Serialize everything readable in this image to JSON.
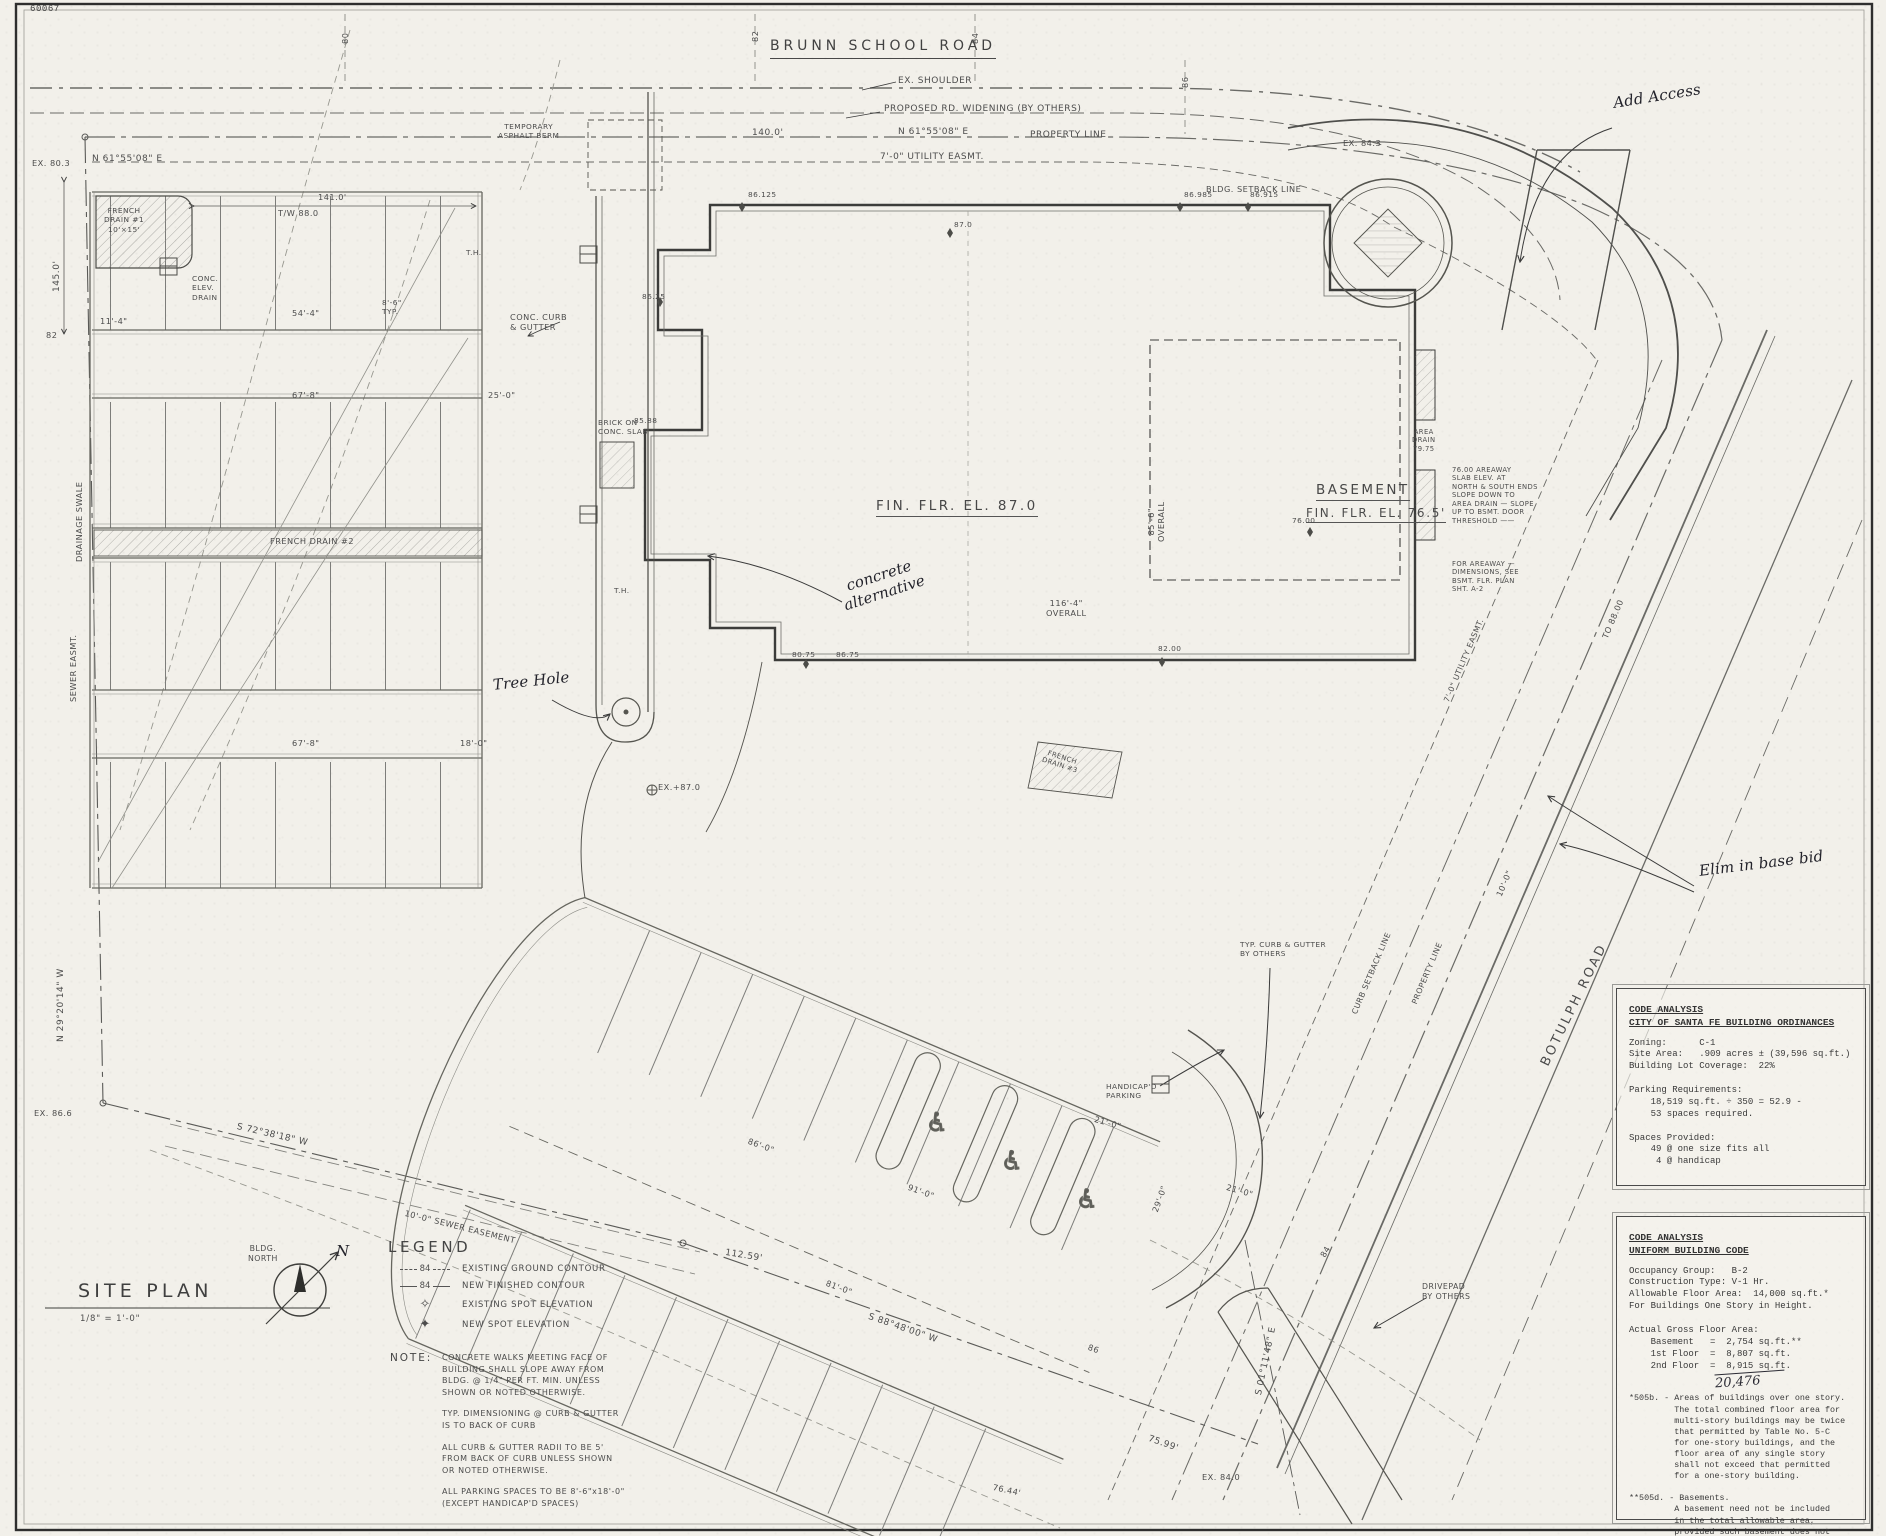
{
  "labels": {
    "sheet_no": "60067",
    "brunn_road": "BRUNN SCHOOL ROAD",
    "ex_shoulder": "EX. SHOULDER",
    "proposed_widening": "PROPOSED RD. WIDENING (BY OTHERS)",
    "dim_140": "140.0'",
    "bearing_ne": "N 61°55'08\" E",
    "property_line": "PROPERTY LINE",
    "utility_easmt": "7'-0\" UTILITY EASMT.",
    "temp_berm": "TEMPORARY\nASPHALT BERM",
    "bldg_setback": "BLDG. SETBACK LINE",
    "ex_843": "EX. 84.3",
    "ex_803": "EX. 80.3",
    "dim_145": "145.0'",
    "tw_880": "T/W 88.0",
    "dim_141": "141.0'",
    "french_drain_1": "FRENCH\nDRAIN #1\n10'×15'",
    "conc_elev_drain": "CONC.\nELEV.\nDRAIN",
    "drainage_swale": "DRAINAGE SWALE",
    "sewer_easmt": "SEWER EASMT.",
    "bearing_nw": "N 29°20'14\" W",
    "ex_866": "EX. 86.6",
    "bearing_sw": "S 72°38'18\" W",
    "sewer_easement_10": "10'-0\" SEWER EASEMENT",
    "dim_54_4": "54'-4\"",
    "dim_8_6": "8'-6\"\nTYP.",
    "dim_11_4": "11'-4\"",
    "dim_67_8": "67'-8\"",
    "dim_25_0": "25'-0\"",
    "dim_18_0": "18'-0\"",
    "conc_curb_gutter": "CONC. CURB\n& GUTTER",
    "french_drain_2": "FRENCH DRAIN #2",
    "french_drain_3": "FRENCH\nDRAIN #3",
    "fin_flr": "FIN. FLR. EL. 87.0",
    "basement": "BASEMENT",
    "basement_ffe": "FIN. FLR. EL. 76.5'",
    "overall_85": "85'-6\"\nOVERALL",
    "overall_116": "116'-4\"\nOVERALL",
    "areaway_note": "76.00 AREAWAY\nSLAB ELEV. AT\nNORTH & SOUTH ENDS\nSLOPE DOWN TO\nAREA DRAIN — SLOPE\nUP TO BSMT. DOOR\nTHRESHOLD ——",
    "areaway_dims": "FOR AREAWAY —\nDIMENSIONS, SEE\nBSMT. FLR. PLAN\nSHT. A-2",
    "area_drain": "AREA\nDRAIN\n79.75",
    "brick_slab": "BRICK ON\nCONC. SLAB",
    "ex_870": "EX.+87.0",
    "to_8800": "TO 88.00",
    "curb_setback": "CURB SETBACK LINE",
    "dim_10_0": "10'-0\"",
    "botulph": "BOTULPH ROAD",
    "typ_curb_others": "TYP. CURB & GUTTER\nBY OTHERS",
    "handicap_parking": "HANDICAP'D\nPARKING",
    "dim_21_0": "21'-0\"",
    "dim_29_0": "29'-0\"",
    "dim_91_0": "91'-0\"",
    "dim_81_0": "81'-0\"",
    "dim_86_0": "86'-0\"",
    "contour_84": "84",
    "contour_86": "86",
    "dim_112_59": "112.59'",
    "bearing_s88": "S 88°48'00\" W",
    "bearing_s01": "S 01°11'48\" E",
    "dim_75_99": "75.99'",
    "ex_840": "EX. 84.0",
    "dim_76_44": "76.44'",
    "drivepad": "DRIVEPAD\nBY OTHERS",
    "t_8200": "82.00",
    "t_7600": "76.00",
    "s86125": "86.125",
    "s86985": "86.985",
    "s86915": "86.915",
    "s870": "87.0",
    "s8625": "86.25",
    "s8588": "85.88",
    "s8075": "80.75",
    "s8675": "86.75",
    "c80": "80",
    "c82": "82",
    "c84": "84",
    "c86": "86",
    "th": "T.H."
  },
  "handwritten": {
    "add_access": "Add Access",
    "elim": "Elim in base bid",
    "concrete_alt": "concrete\nalternative",
    "tree_hole": "Tree Hole",
    "total": "20,476"
  },
  "icons": {
    "handicap": "♿",
    "spot_existing": "✧",
    "spot_new": "✦"
  },
  "legend": {
    "title": "LEGEND",
    "contour_value": "84",
    "existing_contour": "EXISTING GROUND CONTOUR",
    "new_contour": "NEW FINISHED CONTOUR",
    "existing_spot": "EXISTING SPOT ELEVATION",
    "new_spot": "NEW SPOT ELEVATION"
  },
  "notes": {
    "heading": "NOTE:",
    "p1": "CONCRETE WALKS MEETING FACE OF\nBUILDING SHALL SLOPE AWAY FROM\nBLDG. @ 1/4\" PER FT. MIN. UNLESS\nSHOWN OR NOTED OTHERWISE.",
    "p2": "TYP. DIMENSIONING @ CURB & GUTTER\nIS TO BACK OF CURB",
    "p3": "ALL CURB & GUTTER RADII TO BE 5'\nFROM BACK OF CURB UNLESS SHOWN\nOR NOTED OTHERWISE.",
    "p4": "ALL PARKING SPACES TO BE 8'-6\"x18'-0\"\n(EXCEPT HANDICAP'D SPACES)"
  },
  "title_block": {
    "title": "SITE PLAN",
    "scale": "1/8\" = 1'-0\"",
    "compass_label": "BLDG.\nNORTH",
    "north": "N"
  },
  "code_city": {
    "h1": "CODE ANALYSIS",
    "h2": "CITY OF SANTA FE BUILDING ORDINANCES",
    "body": "Zoning:      C-1\nSite Area:   .909 acres ± (39,596 sq.ft.)\nBuilding Lot Coverage:  22%\n\nParking Requirements:\n    18,519 sq.ft. ÷ 350 = 52.9 -\n    53 spaces required.\n\nSpaces Provided:\n    49 @ one size fits all\n     4 @ handicap"
  },
  "code_ubc": {
    "h1": "CODE ANALYSIS",
    "h2": "UNIFORM BUILDING CODE",
    "body1": "Occupancy Group:   B-2\nConstruction Type: V-1 Hr.\nAllowable Floor Area:  14,000 sq.ft.*\nFor Buildings One Story in Height.\n\nActual Gross Floor Area:\n    Basement   =  2,754 sq.ft.**\n    1st Floor  =  8,807 sq.ft.\n    2nd Floor  =  8,915 sq.ft.",
    "body2": "*505b. - Areas of buildings over one story.\n         The total combined floor area for\n         multi-story buildings may be twice\n         that permitted by Table No. 5-C\n         for one-story buildings, and the\n         floor area of any single story\n         shall not exceed that permitted\n         for a one-story building.\n\n**505d. - Basements.\n         A basement need not be included\n         in the total allowable area,\n         provided such basement does not\n         exceed the area permitted for a\n         one-story building."
  }
}
